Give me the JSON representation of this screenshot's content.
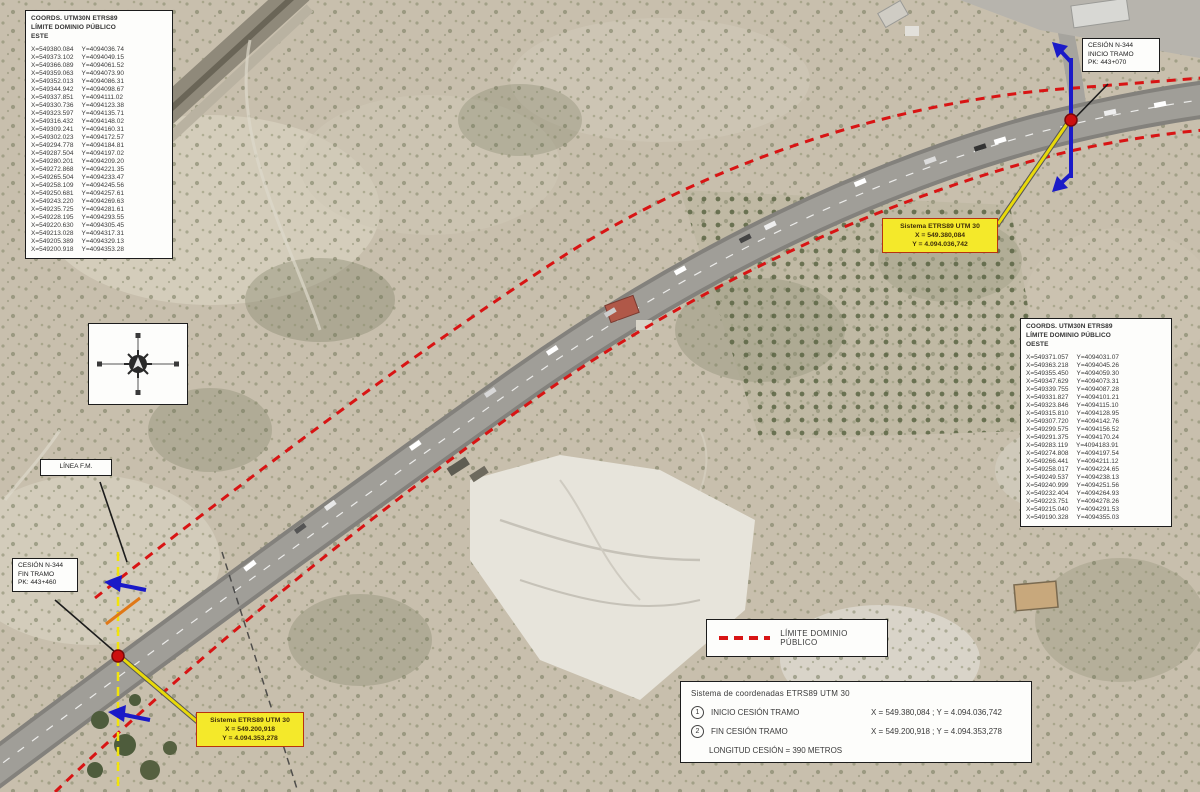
{
  "map": {
    "colors": {
      "boundary_red": "#d81414",
      "marker_blue": "#1a1ac8",
      "callout_yellow": "#f4e92a",
      "road_gray": "#a09e98",
      "point_red": "#cc0f0f"
    },
    "legend": {
      "label": "LÍMITE DOMINIO PÚBLICO"
    },
    "tables": {
      "este": {
        "title_line1": "COORDS. UTM30N ETRS89",
        "title_line2": "LÍMITE DOMINIO PÚBLICO",
        "title_line3": "ESTE",
        "rows": [
          [
            "X=549380.084",
            "Y=4094036.74"
          ],
          [
            "X=549373.102",
            "Y=4094049.15"
          ],
          [
            "X=549366.089",
            "Y=4094061.52"
          ],
          [
            "X=549359.063",
            "Y=4094073.90"
          ],
          [
            "X=549352.013",
            "Y=4094086.31"
          ],
          [
            "X=549344.942",
            "Y=4094098.67"
          ],
          [
            "X=549337.851",
            "Y=4094111.02"
          ],
          [
            "X=549330.736",
            "Y=4094123.38"
          ],
          [
            "X=549323.597",
            "Y=4094135.71"
          ],
          [
            "X=549316.432",
            "Y=4094148.02"
          ],
          [
            "X=549309.241",
            "Y=4094160.31"
          ],
          [
            "X=549302.023",
            "Y=4094172.57"
          ],
          [
            "X=549294.778",
            "Y=4094184.81"
          ],
          [
            "X=549287.504",
            "Y=4094197.02"
          ],
          [
            "X=549280.201",
            "Y=4094209.20"
          ],
          [
            "X=549272.868",
            "Y=4094221.35"
          ],
          [
            "X=549265.504",
            "Y=4094233.47"
          ],
          [
            "X=549258.109",
            "Y=4094245.56"
          ],
          [
            "X=549250.681",
            "Y=4094257.61"
          ],
          [
            "X=549243.220",
            "Y=4094269.63"
          ],
          [
            "X=549235.725",
            "Y=4094281.61"
          ],
          [
            "X=549228.195",
            "Y=4094293.55"
          ],
          [
            "X=549220.630",
            "Y=4094305.45"
          ],
          [
            "X=549213.028",
            "Y=4094317.31"
          ],
          [
            "X=549205.389",
            "Y=4094329.13"
          ],
          [
            "X=549200.918",
            "Y=4094353.28"
          ]
        ]
      },
      "oeste": {
        "title_line1": "COORDS. UTM30N ETRS89",
        "title_line2": "LÍMITE DOMINIO PÚBLICO",
        "title_line3": "OESTE",
        "rows": [
          [
            "X=549371.057",
            "Y=4094031.07"
          ],
          [
            "X=549363.218",
            "Y=4094045.26"
          ],
          [
            "X=549355.450",
            "Y=4094059.30"
          ],
          [
            "X=549347.629",
            "Y=4094073.31"
          ],
          [
            "X=549339.755",
            "Y=4094087.28"
          ],
          [
            "X=549331.827",
            "Y=4094101.21"
          ],
          [
            "X=549323.846",
            "Y=4094115.10"
          ],
          [
            "X=549315.810",
            "Y=4094128.95"
          ],
          [
            "X=549307.720",
            "Y=4094142.76"
          ],
          [
            "X=549299.575",
            "Y=4094156.52"
          ],
          [
            "X=549291.375",
            "Y=4094170.24"
          ],
          [
            "X=549283.119",
            "Y=4094183.91"
          ],
          [
            "X=549274.808",
            "Y=4094197.54"
          ],
          [
            "X=549266.441",
            "Y=4094211.12"
          ],
          [
            "X=549258.017",
            "Y=4094224.65"
          ],
          [
            "X=549249.537",
            "Y=4094238.13"
          ],
          [
            "X=549240.999",
            "Y=4094251.56"
          ],
          [
            "X=549232.404",
            "Y=4094264.93"
          ],
          [
            "X=549223.751",
            "Y=4094278.26"
          ],
          [
            "X=549215.040",
            "Y=4094291.53"
          ],
          [
            "X=549190.328",
            "Y=4094355.03"
          ]
        ]
      }
    },
    "labels": {
      "linea_fm": "LÍNEA F.M.",
      "cesion_inicio": {
        "l1": "CESIÓN N-344",
        "l2": "INICIO TRAMO",
        "l3": "PK: 443+070"
      },
      "cesion_fin": {
        "l1": "CESIÓN N-344",
        "l2": "FIN TRAMO",
        "l3": "PK: 443+460"
      },
      "callout_inicio": {
        "l1": "Sistema ETRS89 UTM 30",
        "l2": "X = 549.380,084",
        "l3": "Y = 4.094.036,742"
      },
      "callout_fin": {
        "l1": "Sistema ETRS89 UTM 30",
        "l2": "X = 549.200,918",
        "l3": "Y = 4.094.353,278"
      }
    },
    "info_box": {
      "title": "Sistema de coordenadas ETRS89 UTM 30",
      "rows": [
        {
          "num": "1",
          "label": "INICIO CESIÓN TRAMO",
          "coords": "X = 549.380,084 ; Y = 4.094.036,742"
        },
        {
          "num": "2",
          "label": "FIN CESIÓN TRAMO",
          "coords": "X = 549.200,918 ; Y = 4.094.353,278"
        }
      ],
      "length": "LONGITUD CESIÓN = 390 METROS"
    }
  }
}
